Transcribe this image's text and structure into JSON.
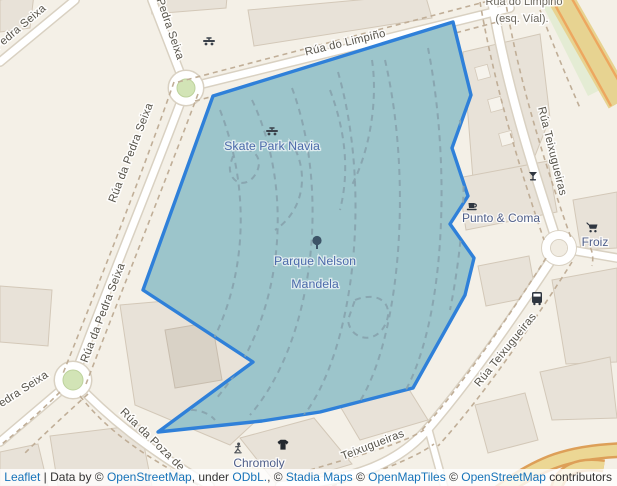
{
  "map": {
    "streets": {
      "limpino": "Rúa do Limpiño",
      "limpino_esq_line1": "Rúa do Limpiño",
      "limpino_esq_line2": "(esq. Víal).",
      "pedra_seixa": "Rúa da Pedra Seixa",
      "pedra_seixa_short": "Pedra Seixa",
      "poza": "Rúa da Poza de",
      "teixugueiras": "Rúa Teixugueiras",
      "teixugueiras_short": "Teixugueiras"
    },
    "pois": {
      "skate_park": "Skate Park Navia",
      "parque_line1": "Parque Nelson",
      "parque_line2": "Mandela",
      "punto_coma": "Punto & Coma",
      "froiz": "Froiz",
      "chromoly": "Chromoly"
    },
    "colors": {
      "background": "#f4f0e7",
      "building": "#e8e2d8",
      "road_fill": "#ffffff",
      "road_casing": "#d9d1c2",
      "polygon_fill": "#9cc5cb",
      "polygon_stroke": "#2f80d9",
      "park_path_dash": "#87a2ad",
      "side_path_dash": "#c0ae97",
      "roundabout_green": "#d2e4b6",
      "highway_fill": "#e7d391",
      "highway_casing": "#eda75f",
      "street_label": "#57544b",
      "leisure_label": "#4d6bab",
      "shop_label": "#4f5f8a",
      "link": "#1673b9"
    }
  },
  "attribution": {
    "leaflet": "Leaflet",
    "d1": " | Data by © ",
    "osm": "OpenStreetMap",
    "d2": ", under ",
    "odbl": "ODbL.",
    "d3": ", © ",
    "stadia": "Stadia Maps",
    "d4": " © ",
    "openmaptiles": "OpenMapTiles",
    "d5": " © ",
    "osm2": "OpenStreetMap",
    "d6": " contributors"
  }
}
